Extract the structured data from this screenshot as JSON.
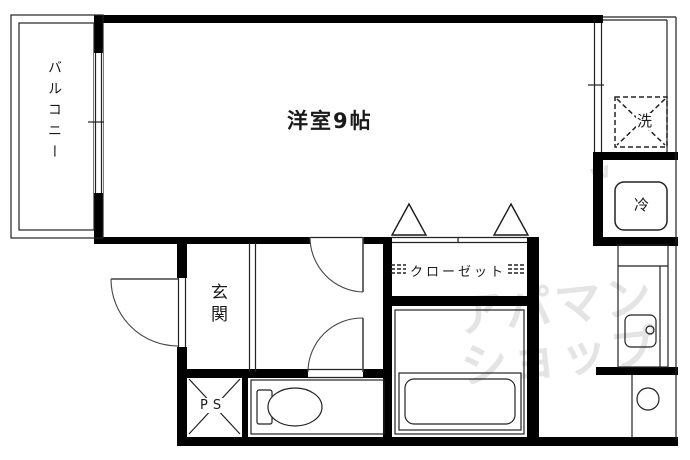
{
  "floorplan": {
    "title": "apartment-floor-plan",
    "rooms": {
      "balcony": {
        "label": "バルコニー"
      },
      "main_room": {
        "label": "洋室9帖"
      },
      "entrance": {
        "label": "玄関"
      },
      "closet": {
        "label": "クローゼット"
      }
    },
    "fixtures": {
      "washer_space": {
        "label": "洗"
      },
      "refrigerator": {
        "label": "冷"
      },
      "pipe_space": {
        "label": "PS"
      }
    },
    "watermark": {
      "line1": "アパマン",
      "line2": "ショップ",
      "accent": "w",
      "color": "#e4e4e4"
    },
    "colors": {
      "wall": "#000000",
      "thin_line": "#222222",
      "door_arc": "#444444",
      "background": "#ffffff"
    }
  }
}
